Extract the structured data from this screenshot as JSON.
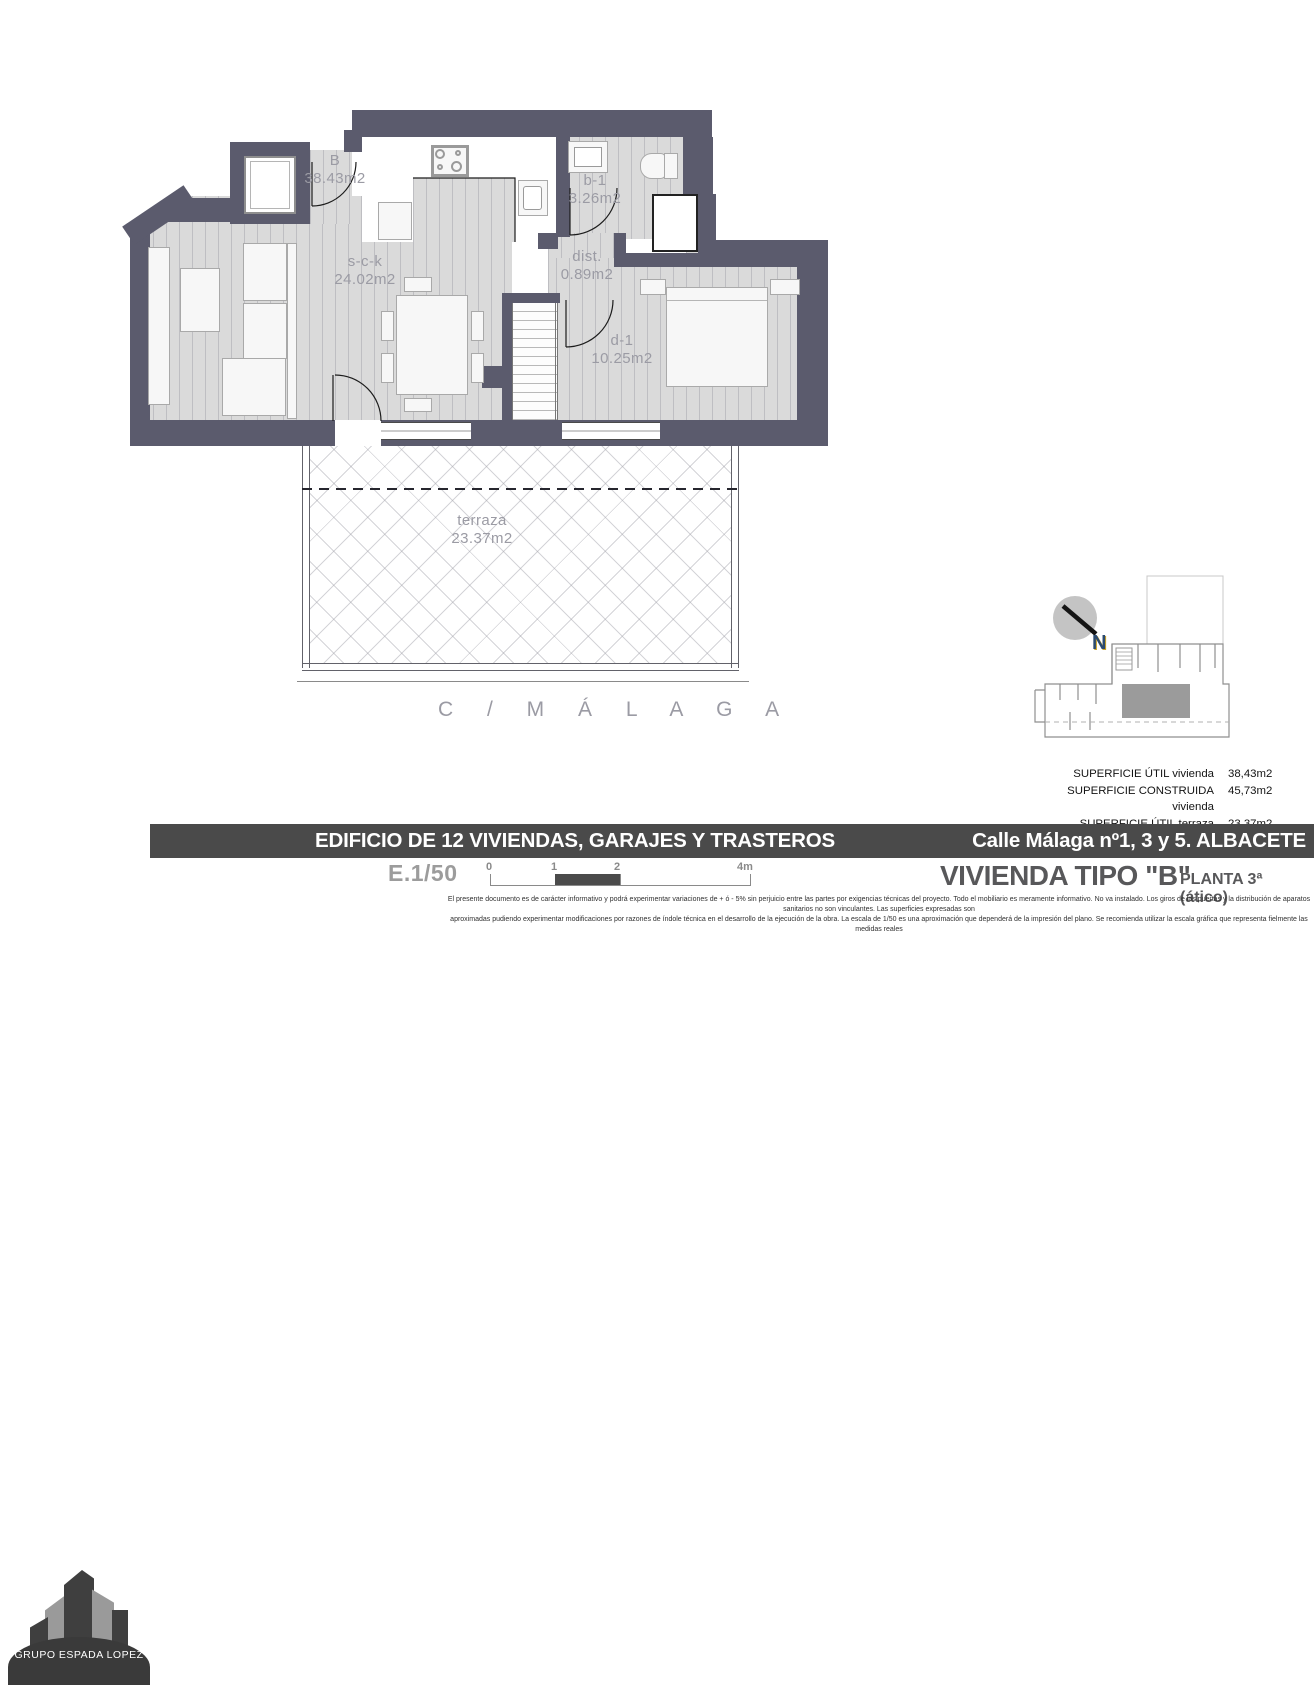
{
  "plan": {
    "apartment": {
      "name": "B",
      "area": "38.43m2"
    },
    "rooms": [
      {
        "name": "s-c-k",
        "area": "24.02m2"
      },
      {
        "name": "b-1",
        "area": "3.26m2"
      },
      {
        "name": "dist.",
        "area": "0.89m2"
      },
      {
        "name": "d-1",
        "area": "10.25m2"
      },
      {
        "name": "terraza",
        "area": "23.37m2"
      }
    ],
    "street_label": "C / M Á L A G A",
    "north_label": "N"
  },
  "summary": {
    "rows": [
      {
        "label": "SUPERFICIE ÚTIL vivienda",
        "value": "38,43m2"
      },
      {
        "label": "SUPERFICIE CONSTRUIDA vivienda",
        "value": "45,73m2"
      },
      {
        "label": "SUPERFICIE ÚTIL terraza descubierta",
        "value": "23,37m2"
      }
    ]
  },
  "titleblock": {
    "project_title": "EDIFICIO DE 12 VIVIENDAS, GARAJES Y TRASTEROS",
    "address": "Calle Málaga nº1, 3 y 5. ALBACETE",
    "scale": "E.1/50",
    "scale_ticks": [
      "0",
      "1",
      "2",
      "4m"
    ],
    "unit_title": "VIVIENDA TIPO \"B\"",
    "floor": "PLANTA 3ª (ático)",
    "disclaimer_line1": "El presente documento es de carácter informativo y podrá experimentar variaciones de + ó - 5% sin perjuicio entre las partes por exigencias técnicas del proyecto. Todo el mobiliario es meramente informativo. No va instalado. Los giros de las puertas y la distribución de aparatos sanitarios no son vinculantes. Las superficies expresadas son",
    "disclaimer_line2": "aproximadas pudiendo experimentar modificaciones por razones de índole técnica en el desarrollo de la ejecución de la obra. La escala de 1/50 es una aproximación que dependerá de la impresión del plano. Se recomienda utilizar la escala gráfica que representa fielmente las medidas reales"
  },
  "logo": {
    "company": "GRUPO ESPADA LOPEZ"
  },
  "colors": {
    "wall": "#5b5b6d",
    "band": "#4a4a4a",
    "room_label": "#9b9ba4",
    "accent_text": "#58585a"
  }
}
